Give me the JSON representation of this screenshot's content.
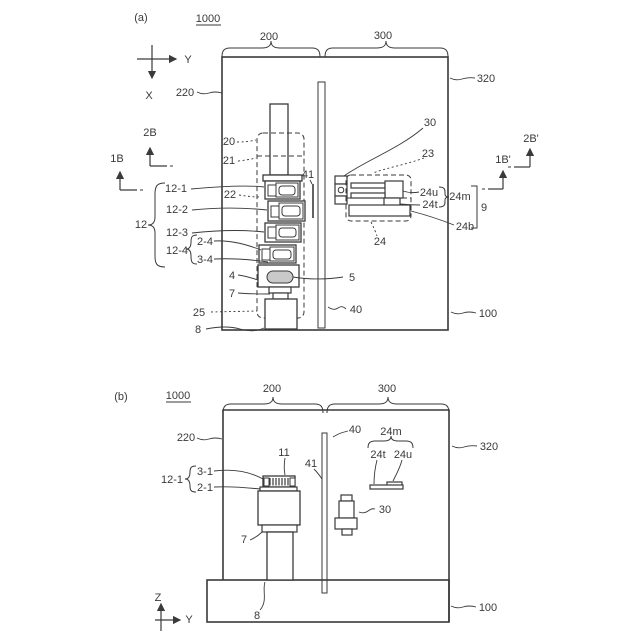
{
  "colors": {
    "line": "#3a3a3a",
    "shade": "#c9c9c9",
    "background": "#ffffff"
  },
  "panel_a": {
    "tag": "(a)",
    "ref_number": "1000",
    "zone_left": "200",
    "zone_right": "300",
    "wall_label": "220",
    "housing_label": "320",
    "axis_right": "Y",
    "axis_down": "X",
    "section_upper_left": "2B",
    "section_lower_left": "1B",
    "section_upper_right": "2B'",
    "section_lower_right": "1B'",
    "stack_group": "12",
    "unit_1": "12-1",
    "unit_2": "12-2",
    "unit_3": "12-3",
    "unit_4": "12-4",
    "sub_unit_top": "2-4",
    "sub_unit_bottom": "3-4",
    "label_20": "20",
    "label_21": "21",
    "label_22": "22",
    "label_41": "41",
    "label_30": "30",
    "label_23": "23",
    "label_24u": "24u",
    "label_24m": "24m",
    "label_24t": "24t",
    "label_9": "9",
    "label_24b": "24b",
    "label_24": "24",
    "label_4": "4",
    "label_7": "7",
    "label_5": "5",
    "label_25": "25",
    "label_40": "40",
    "label_8": "8",
    "base_label": "100"
  },
  "panel_b": {
    "tag": "(b)",
    "ref_number": "1000",
    "zone_left": "200",
    "zone_right": "300",
    "wall_label": "220",
    "housing_label": "320",
    "label_40": "40",
    "label_24m": "24m",
    "label_24t": "24t",
    "label_24u": "24u",
    "label_11": "11",
    "label_41": "41",
    "unit_group": "12-1",
    "sub_top": "3-1",
    "sub_bottom": "2-1",
    "label_30": "30",
    "label_7": "7",
    "label_8": "8",
    "base_label": "100",
    "axis_up": "Z",
    "axis_right": "Y"
  }
}
